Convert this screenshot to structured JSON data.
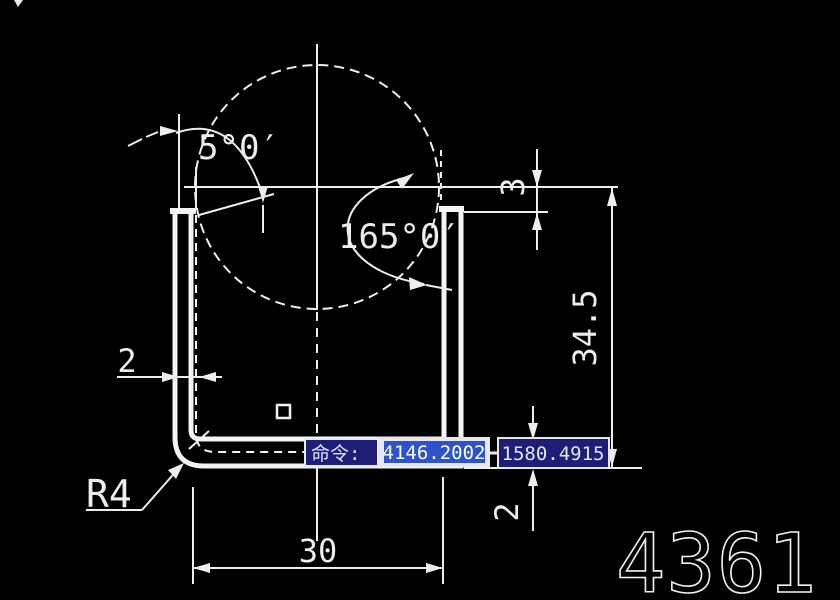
{
  "canvas": {
    "bg": "#000000",
    "ink": "#f0f0f0"
  },
  "drawing": {
    "number": "4361"
  },
  "dimensions": {
    "angle_left": "5°0′",
    "angle_right": "165°0′",
    "offset_top_right": "3",
    "height_right": "34.5",
    "web_thickness": "2",
    "flange_thickness": "2",
    "width_bottom": "30",
    "fillet": "R4"
  },
  "command_bar": {
    "prompt": "命令:",
    "x_value": "4146.2002",
    "y_value": "1580.4915",
    "prompt_bg": "#1e1e78",
    "active_bg": "#2d53cc",
    "field_bg": "#1e1e78",
    "frame": "#e8e8e8",
    "text_color": "#ffffff"
  }
}
